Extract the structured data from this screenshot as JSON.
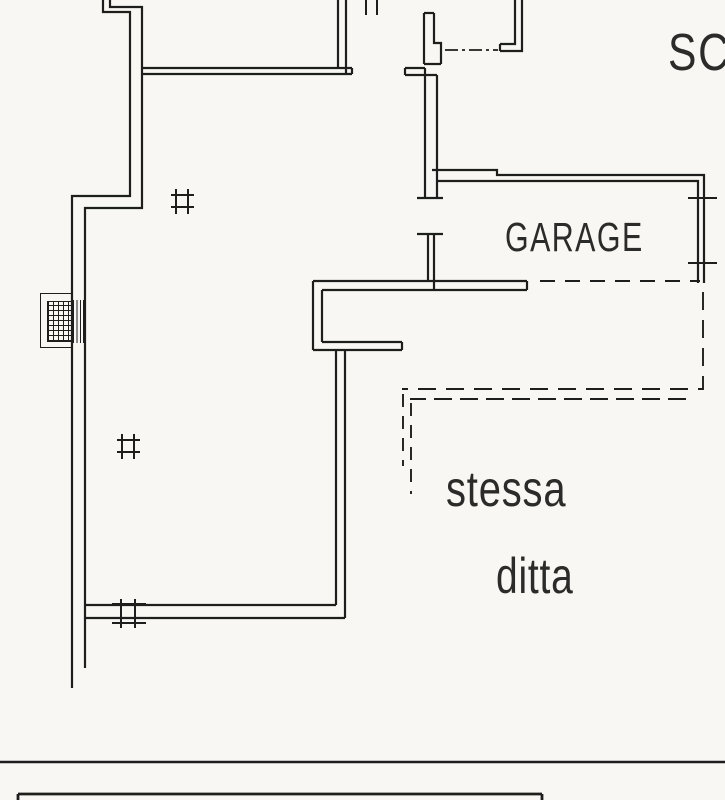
{
  "page": {
    "background_color": "#f8f7f4",
    "line_color": "#1e1e1c",
    "text_color": "#2b2b29",
    "drawing_type": "architectural floor plan (CAD line drawing)"
  },
  "labels": {
    "garage": "GARAGE",
    "stessa": "stessa",
    "ditta": "ditta",
    "scale_text_partial": "SC"
  },
  "symbols": {
    "window_tick_marks": 3,
    "names": [
      "window-tick-mark",
      "chimney-flue-hatch",
      "door-opening-mark",
      "boundary-dash-dot-line",
      "dashed-outline-same-owner-area",
      "wall-section-break-ticks",
      "footer-separator-line",
      "footer-title-block-edge"
    ]
  }
}
